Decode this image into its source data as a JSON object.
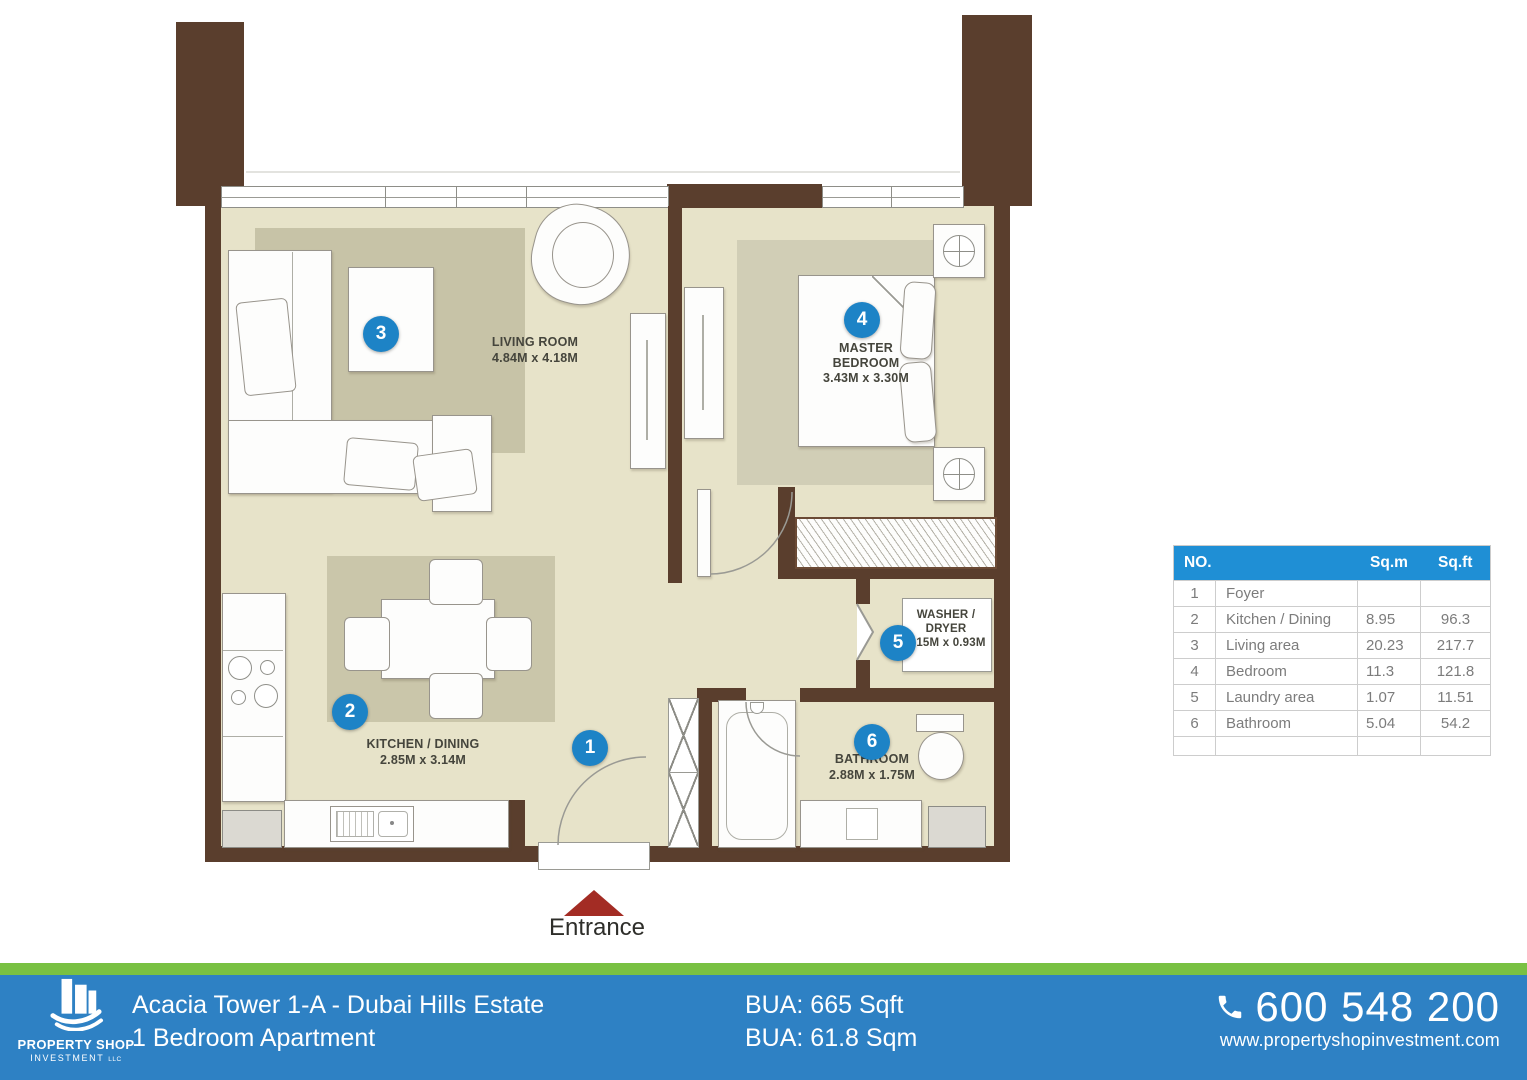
{
  "plan": {
    "entrance_label": "Entrance",
    "markers": {
      "foyer": "1",
      "kitchen": "2",
      "living": "3",
      "bedroom": "4",
      "laundry": "5",
      "bathroom": "6"
    },
    "rooms": {
      "living": {
        "name": "LIVING ROOM",
        "dims": "4.84M x 4.18M"
      },
      "master": {
        "name_line1": "MASTER",
        "name_line2": "BEDROOM",
        "dims": "3.43M x 3.30M"
      },
      "kitchen": {
        "name": "KITCHEN / DINING",
        "dims": "2.85M x 3.14M"
      },
      "laundry": {
        "name_line1": "WASHER /",
        "name_line2": "DRYER",
        "dims": "1.15M x 0.93M"
      },
      "bathroom": {
        "name": "BATHROOM",
        "dims": "2.88M x 1.75M"
      }
    }
  },
  "area_table": {
    "headers": {
      "no": "NO.",
      "sqm": "Sq.m",
      "sqft": "Sq.ft"
    },
    "rows": [
      {
        "no": "1",
        "name": "Foyer",
        "sqm": "",
        "sqft": ""
      },
      {
        "no": "2",
        "name": "Kitchen / Dining",
        "sqm": "8.95",
        "sqft": "96.3"
      },
      {
        "no": "3",
        "name": "Living area",
        "sqm": "20.23",
        "sqft": "217.7"
      },
      {
        "no": "4",
        "name": "Bedroom",
        "sqm": "11.3",
        "sqft": "121.8"
      },
      {
        "no": "5",
        "name": "Laundry area",
        "sqm": "1.07",
        "sqft": "11.51"
      },
      {
        "no": "6",
        "name": "Bathroom",
        "sqm": "5.04",
        "sqft": "54.2"
      }
    ]
  },
  "footer": {
    "logo": {
      "line1": "PROPERTY SHOP",
      "line2": "INVESTMENT",
      "line2_suffix": "LLC"
    },
    "title_line1": "Acacia Tower 1-A - Dubai Hills Estate",
    "title_line2": "1 Bedroom Apartment",
    "bua_line1": "BUA: 665 Sqft",
    "bua_line2": "BUA: 61.8 Sqm",
    "phone": "600 548 200",
    "website": "www.propertyshopinvestment.com"
  },
  "colors": {
    "accent_blue": "#1d83c6",
    "table_header_blue": "#1f8fd5",
    "footer_blue": "#2e81c4",
    "footer_green": "#79c143",
    "wall_brown": "#5a3e2d",
    "entrance_red": "#a32c24",
    "floor_beige": "#e7e3c9"
  }
}
